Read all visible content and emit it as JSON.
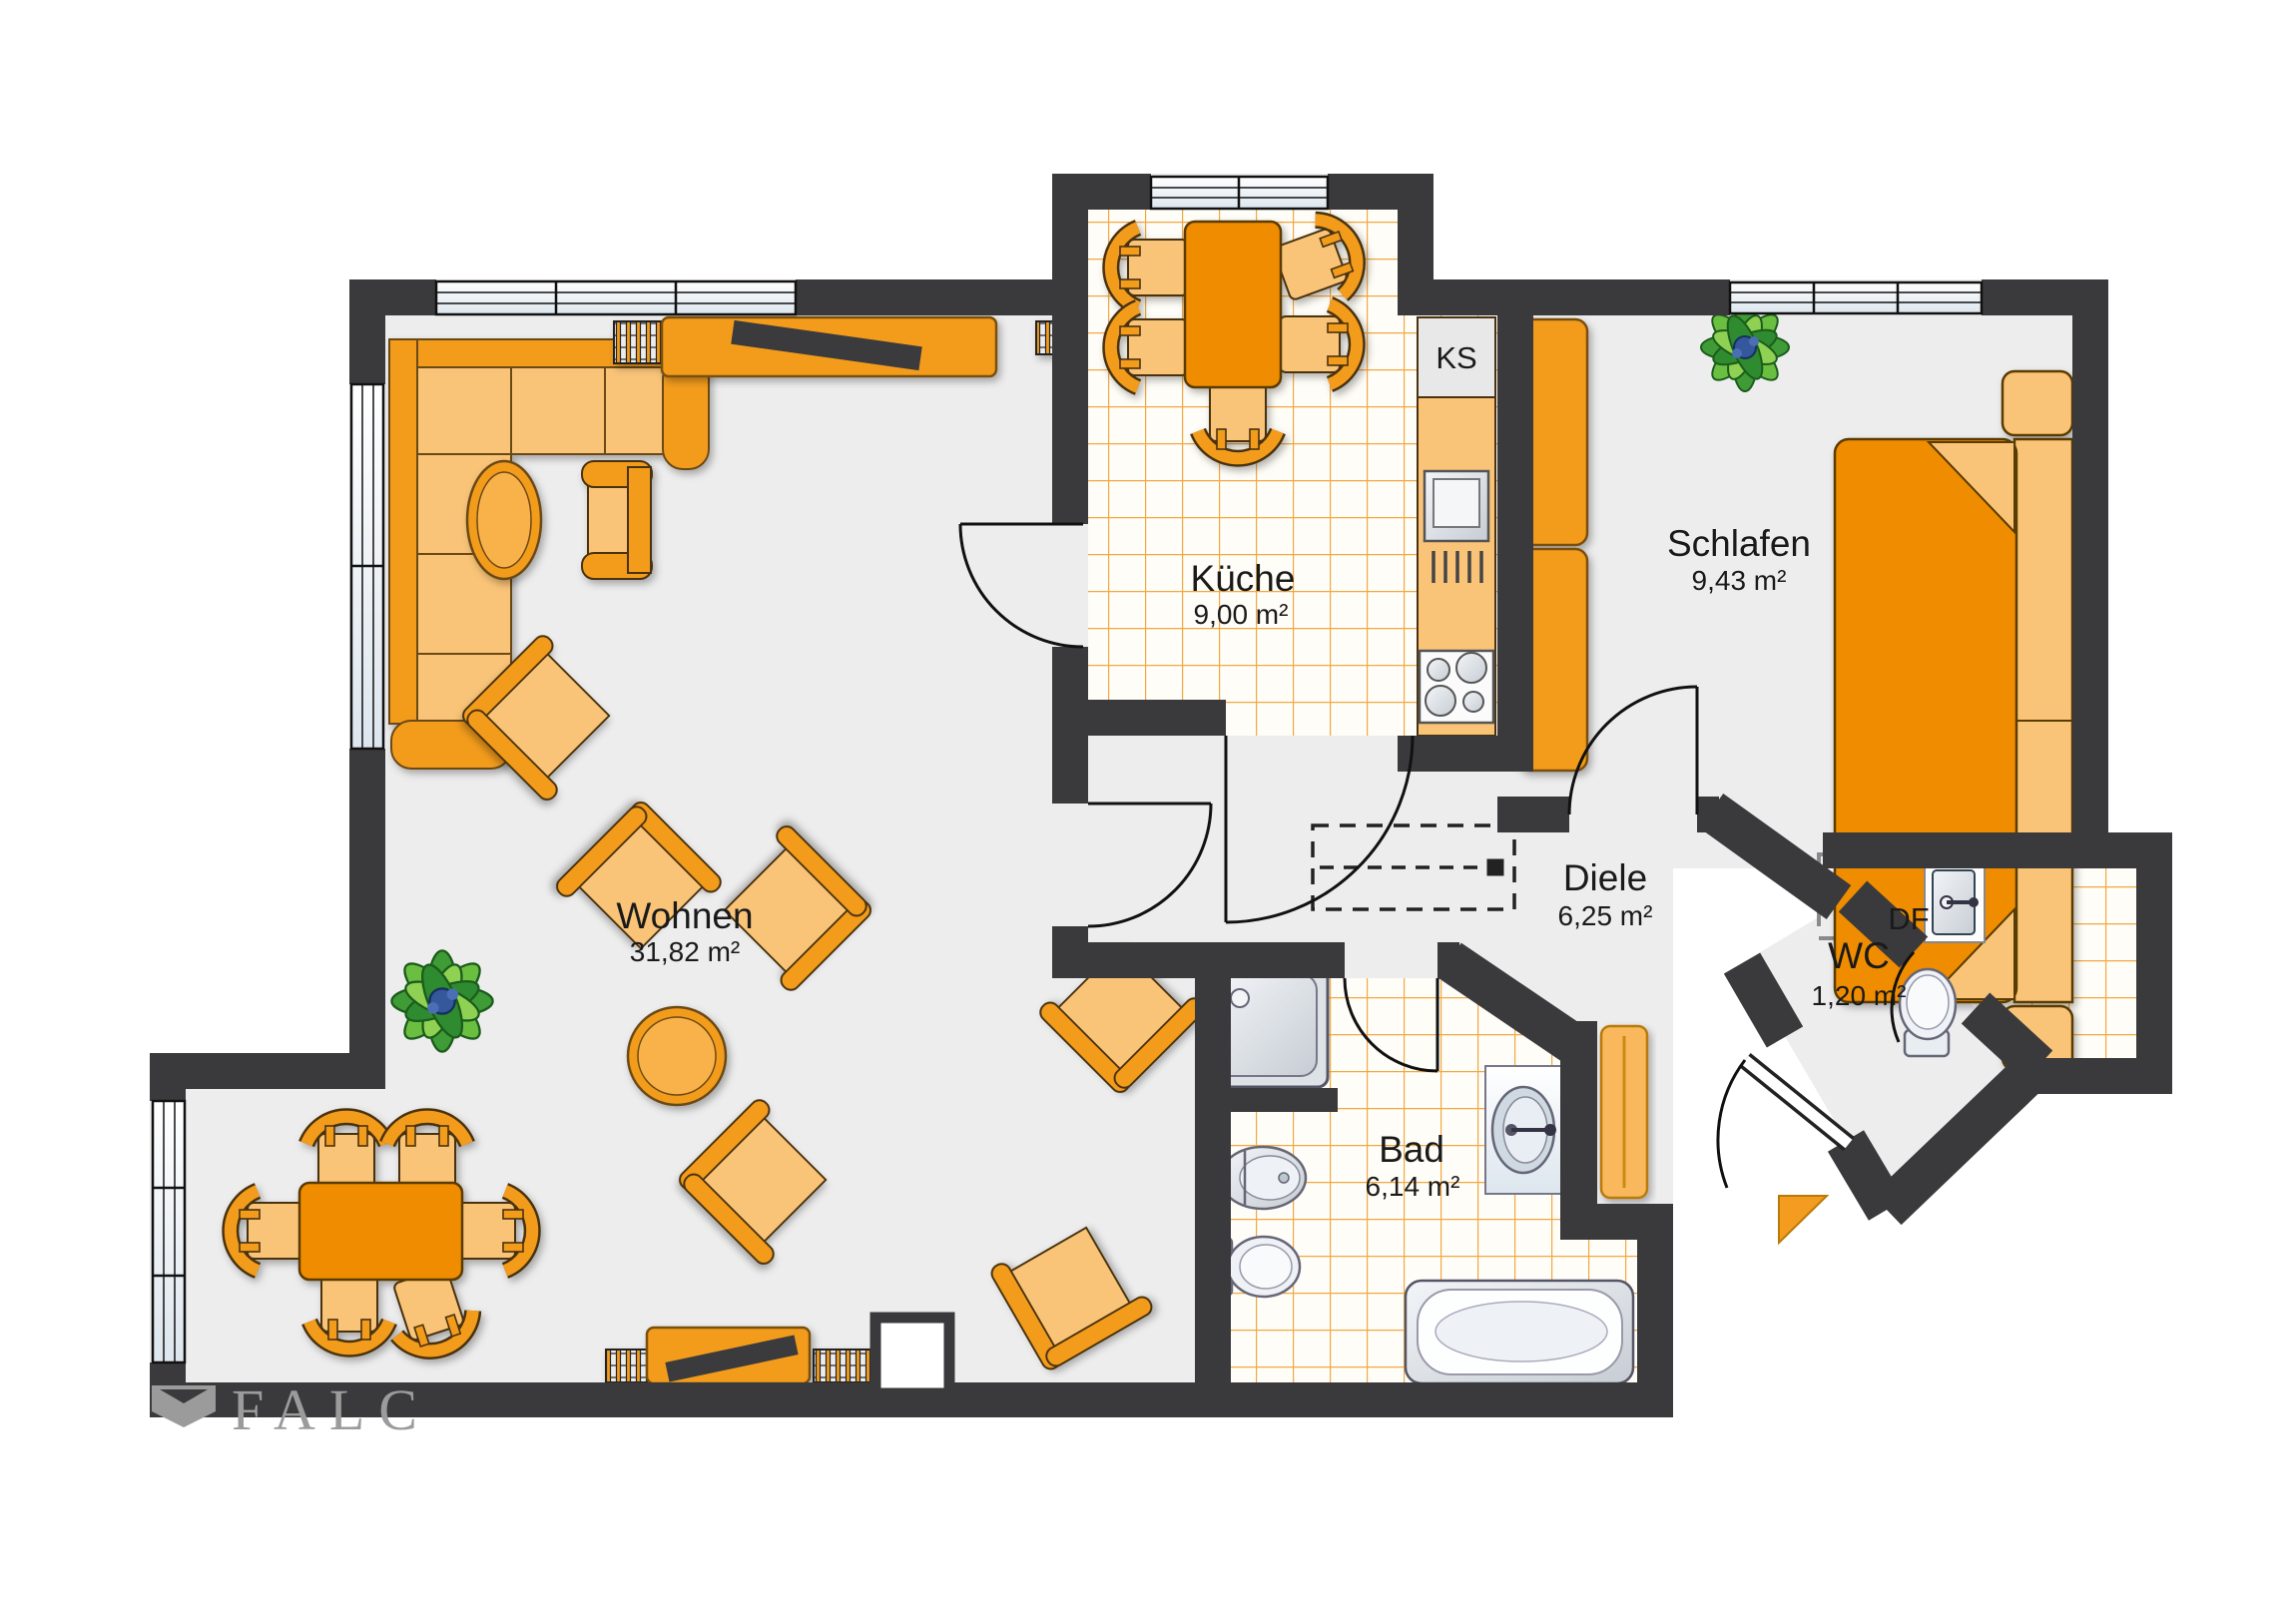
{
  "plan": {
    "type": "apartment-floor-plan",
    "watermark": {
      "text": "FALC"
    },
    "rooms": [
      {
        "id": "wohnen",
        "name": "Wohnen",
        "area": "31,82 m²"
      },
      {
        "id": "kueche",
        "name": "Küche",
        "area": "9,00 m²"
      },
      {
        "id": "schlafen",
        "name": "Schlafen",
        "area": "9,43 m²"
      },
      {
        "id": "diele",
        "name": "Diele",
        "area": "6,25 m²"
      },
      {
        "id": "bad",
        "name": "Bad",
        "area": "6,14 m²"
      },
      {
        "id": "wc",
        "name": "WC",
        "area": "1,20 m²"
      }
    ],
    "annotations": {
      "fridge_label": "KS",
      "roof_window_label": "DF"
    },
    "palette": {
      "wall": "#3a3a3c",
      "floor": "#ededee",
      "tile_line": "#f1a843",
      "furniture_orange": "#f39c1f",
      "furniture_light": "#f9c478",
      "furniture_deep": "#ef8c00",
      "appliance_grey": "#dfe3e6",
      "plant_green": "#4aa832",
      "watermark_grey": "#9b9b9b"
    },
    "furniture_legend": [
      "corner-sofa",
      "oval-side-table",
      "armchair",
      "lounge-chair",
      "round-coffee-table",
      "tv-sideboard",
      "shelf-slats",
      "dining-table",
      "dining-chair",
      "kitchen-table",
      "fridge",
      "oven",
      "stove",
      "kitchen-counter",
      "wardrobe",
      "double-bed",
      "nightstand",
      "plant",
      "shower",
      "toilet",
      "bidet",
      "washbasin",
      "bathtub",
      "radiator",
      "dashed-wardrobe",
      "roof-window",
      "entrance-marker"
    ]
  }
}
